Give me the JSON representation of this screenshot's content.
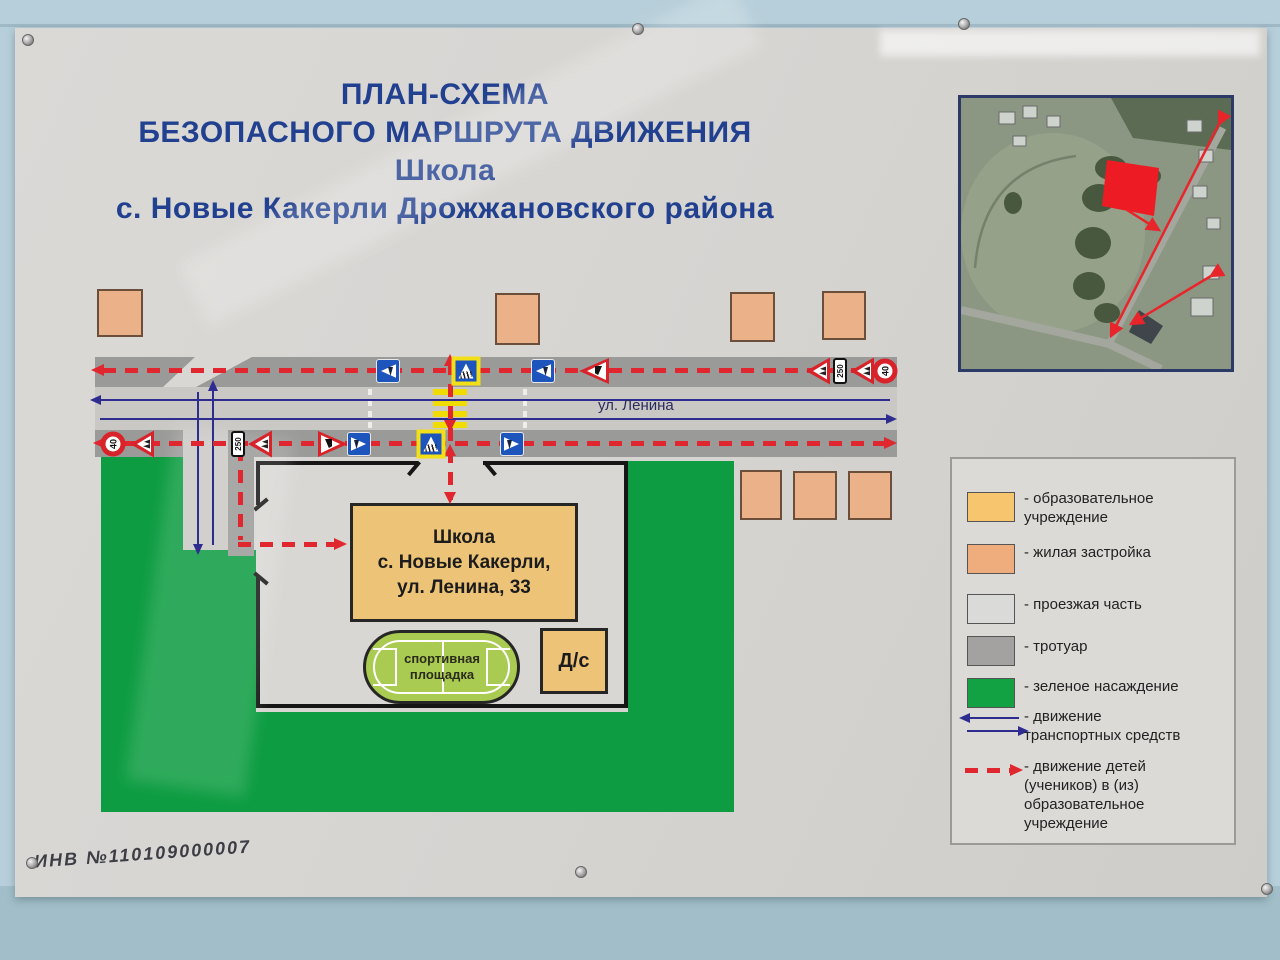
{
  "title": {
    "line1": "ПЛАН-СХЕМА",
    "line2": "БЕЗОПАСНОГО МАРШРУТА ДВИЖЕНИЯ",
    "line3": "Школа",
    "line4": "с. Новые Какерли Дрожжановского района"
  },
  "map": {
    "street_label": "ул. Ленина",
    "school_label": "Школа\nс. Новые Какерли,\nул. Ленина, 33",
    "sport_label": "спортивная\nплощадка",
    "kindergarten_label": "Д/с"
  },
  "legend": {
    "items": [
      {
        "label": "- образовательное\nучреждение",
        "swatch": "education"
      },
      {
        "label": "- жилая застройка",
        "swatch": "residential"
      },
      {
        "label": "- проезжая часть",
        "swatch": "roadway"
      },
      {
        "label": "- тротуар",
        "swatch": "sidewalk"
      },
      {
        "label": "- зеленое насаждение",
        "swatch": "greenery"
      },
      {
        "label": "- движение\nтранспортных средств",
        "swatch": "vehicle-arrows"
      },
      {
        "label": "- движение детей\n(учеников) в (из)\nобразовательное\nучреждение",
        "swatch": "children-arrow"
      }
    ],
    "swatch_colors": {
      "education": "#f6c56d",
      "residential": "#efad7e",
      "roadway": "#dadad8",
      "sidewalk": "#a3a2a1",
      "greenery": "#12a244"
    }
  },
  "inventory": "ИНВ №110109000007",
  "colors": {
    "wall": "#b7cfda",
    "wallBottom": "#a2bfc9",
    "poster": "#d7d5d2",
    "titleBlue": "#21408f",
    "road": "#c9c8c5",
    "sidewalk": "#9a9a98",
    "green": "#0d9c41",
    "territory": "#d9d7d4",
    "schoolFill": "#ecc377",
    "houseFill": "#ebb189",
    "fieldFill": "#a9cb52",
    "lineBlue": "#2e2d8f",
    "routeRed": "#e0262e",
    "zebraYellow": "#f0dc00",
    "legendBg": "#dcdad7",
    "satRed": "#e8252a"
  },
  "signs": [
    {
      "name": "pedestrian-crossing-left-sign",
      "type": "blue-tri-left",
      "x": 388,
      "y": 371,
      "rot": 0
    },
    {
      "name": "crosswalk-yellow-sign",
      "type": "ped-yellow",
      "x": 466,
      "y": 371,
      "rot": 0
    },
    {
      "name": "pedestrian-crossing-left-sign",
      "type": "blue-tri-left",
      "x": 543,
      "y": 371,
      "rot": 0
    },
    {
      "name": "give-way-sign",
      "type": "giveway-left",
      "x": 594,
      "y": 371,
      "rot": 0
    },
    {
      "name": "children-warning-sign",
      "type": "deti",
      "x": 818,
      "y": 371,
      "rot": -90
    },
    {
      "name": "distance-250-plate",
      "type": "plate250",
      "x": 840,
      "y": 371,
      "rot": -90,
      "label": "250"
    },
    {
      "name": "children-warning-sign",
      "type": "deti",
      "x": 862,
      "y": 371,
      "rot": -90
    },
    {
      "name": "speed-limit-40-sign",
      "type": "s40",
      "x": 885,
      "y": 371,
      "rot": -90,
      "label": "40"
    },
    {
      "name": "speed-limit-40-sign",
      "type": "s40",
      "x": 113,
      "y": 444,
      "rot": -90,
      "label": "40"
    },
    {
      "name": "children-warning-sign",
      "type": "deti",
      "x": 142,
      "y": 444,
      "rot": -90
    },
    {
      "name": "distance-250-plate",
      "type": "plate250",
      "x": 238,
      "y": 444,
      "rot": -90,
      "label": "250"
    },
    {
      "name": "children-warning-sign",
      "type": "deti",
      "x": 260,
      "y": 444,
      "rot": -90
    },
    {
      "name": "give-way-sign",
      "type": "giveway-right",
      "x": 333,
      "y": 444,
      "rot": 0
    },
    {
      "name": "pedestrian-crossing-right-sign",
      "type": "blue-tri-right",
      "x": 359,
      "y": 444,
      "rot": 0
    },
    {
      "name": "crosswalk-yellow-sign",
      "type": "ped-yellow",
      "x": 431,
      "y": 444,
      "rot": 0
    },
    {
      "name": "pedestrian-crossing-right-sign",
      "type": "blue-tri-right",
      "x": 512,
      "y": 444,
      "rot": 0
    }
  ],
  "houses": [
    {
      "x": 97,
      "y": 289,
      "w": 46,
      "h": 48
    },
    {
      "x": 495,
      "y": 293,
      "w": 45,
      "h": 52
    },
    {
      "x": 730,
      "y": 292,
      "w": 45,
      "h": 50
    },
    {
      "x": 822,
      "y": 291,
      "w": 44,
      "h": 49
    },
    {
      "x": 740,
      "y": 470,
      "w": 42,
      "h": 50
    },
    {
      "x": 793,
      "y": 471,
      "w": 44,
      "h": 49
    },
    {
      "x": 848,
      "y": 471,
      "w": 44,
      "h": 49
    }
  ],
  "screws": [
    {
      "x": 27,
      "y": 39
    },
    {
      "x": 637,
      "y": 28
    },
    {
      "x": 963,
      "y": 23
    },
    {
      "x": 31,
      "y": 862
    },
    {
      "x": 580,
      "y": 871
    },
    {
      "x": 1266,
      "y": 888
    }
  ]
}
